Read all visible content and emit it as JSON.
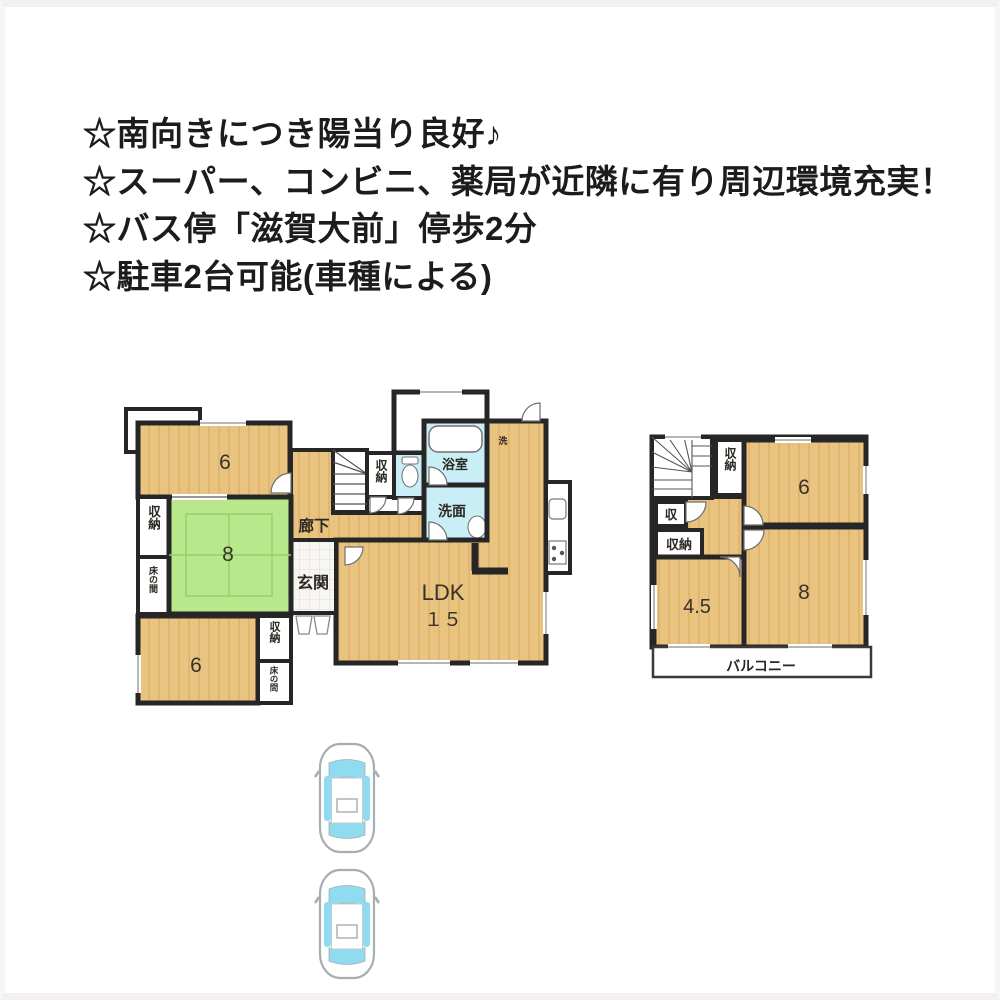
{
  "notes": {
    "lines": [
      "☆南向きにつき陽当り良好♪",
      "☆スーパー、コンビニ、薬局が近隣に有り周辺環境充実！",
      "☆バス停「滋賀大前」停歩2分",
      "☆駐車2台可能(車種による)"
    ]
  },
  "floor1": {
    "bedroom6_top": "6",
    "closet_left": "収納",
    "tokonoma_left": "床の間",
    "tatami8": "8",
    "bedroom6_bottom": "6",
    "closet_bottom": "収納",
    "tokonoma_bottom": "床の間",
    "hallway": "廊下",
    "entrance": "玄関",
    "hall_closet": "収納",
    "bath": "浴室",
    "washroom": "洗面",
    "laundry": "洗",
    "ldk": "LDK",
    "ldk_size": "１５"
  },
  "floor2": {
    "closet_top": "収納",
    "bedroom6": "6",
    "closet_small": "収",
    "closet_mid": "収納",
    "room_4_5": "4.5",
    "bedroom8": "8",
    "balcony": "バルコニー"
  },
  "palette": {
    "wood_floor": "#e9c380",
    "wood_grain": "#dcaf68",
    "tatami": "#b9e78c",
    "tatami_line": "#94cf66",
    "wet_area": "#c9eef5",
    "wall": "#262626",
    "car_glass": "#8fdcf0",
    "car_outline": "#a7adb0",
    "tile": "#f7f6f3",
    "text": "#1c1c1c"
  }
}
